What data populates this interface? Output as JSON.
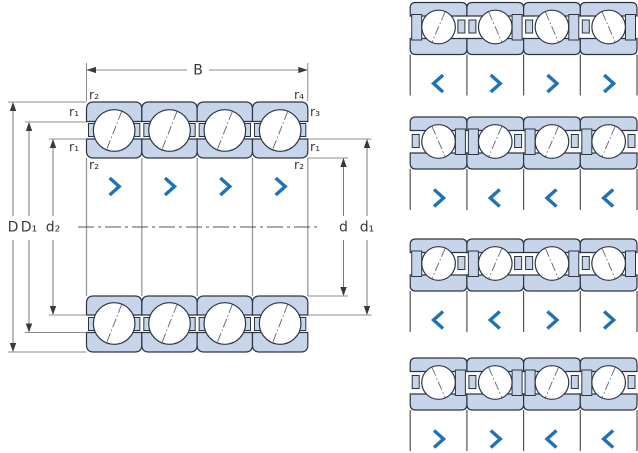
{
  "figure": {
    "type": "bearing-cross-section-with-arrangements",
    "dimensions": {
      "B": "B",
      "D": "D",
      "D1": "D₁",
      "d2": "d₂",
      "d": "d",
      "d1": "d₁"
    },
    "fillets": {
      "top_left": "r₂",
      "top_right": "r₄",
      "left_upper": "r₁",
      "right_upper": "r₃",
      "left_lower": "r₁",
      "right_lower": "r₁",
      "bottom_left": "r₂",
      "bottom_right": "r₂"
    },
    "main_arrows": [
      "right",
      "right",
      "right",
      "right"
    ],
    "arrangements": [
      {
        "arrows": [
          "left",
          "right",
          "right",
          "right"
        ]
      },
      {
        "arrows": [
          "right",
          "left",
          "left",
          "left"
        ]
      },
      {
        "arrows": [
          "left",
          "left",
          "right",
          "right"
        ]
      },
      {
        "arrows": [
          "right",
          "right",
          "left",
          "left"
        ]
      }
    ],
    "colors": {
      "ring_fill": "#c7d4e9",
      "outline": "#2a3642",
      "chevron": "#1e72b5",
      "dim_line": "#8c8c8c",
      "dim_dark": "#777777",
      "boundary_line": "#999999",
      "arrow_fill": "#3a3a3a",
      "centerline": "#555555",
      "ball_axis": "#5a6570",
      "text": "#3a3a3a"
    }
  }
}
